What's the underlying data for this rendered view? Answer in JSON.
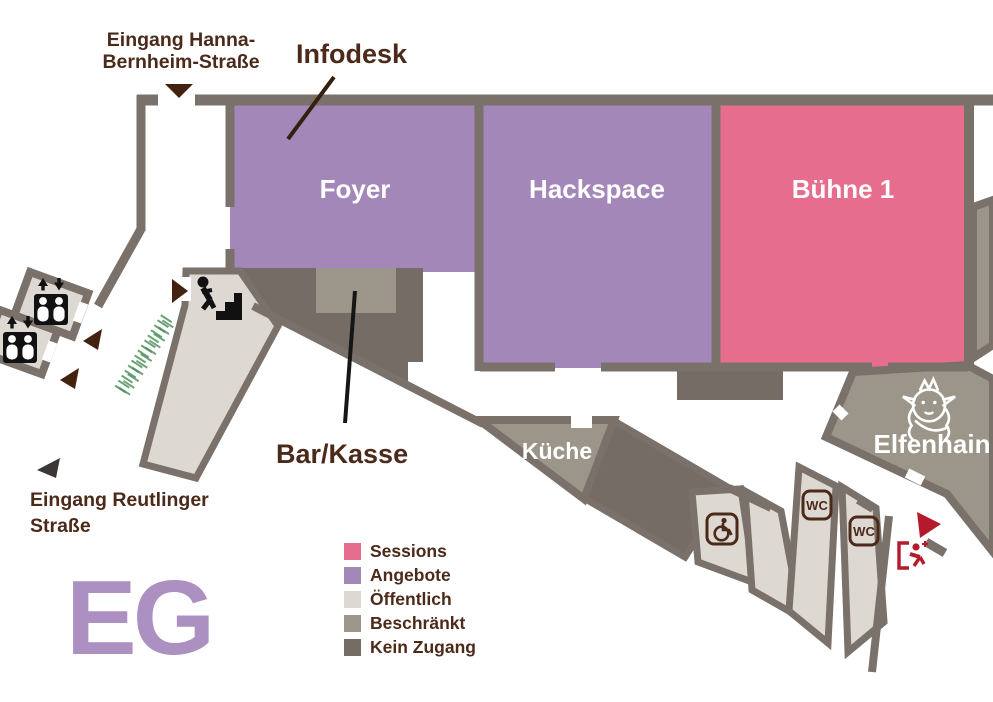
{
  "floor": {
    "label": "EG"
  },
  "colors": {
    "sessions": "#e66d8e",
    "angebote": "#a287b8",
    "oeffentlich": "#ded8d3",
    "beschraenkt": "#9b9689",
    "kein_zugang": "#756c66",
    "wall": "#7a716b",
    "label_brown": "#4b2a1a",
    "arrow_brown": "#42210f",
    "arrow_dark": "#3a3734",
    "exit_red": "#b51a2c",
    "hedge_green": "#6aa373",
    "eg_purple": "#ab90c1",
    "room_label_white": "#ffffff"
  },
  "rooms": {
    "foyer": {
      "label": "Foyer",
      "category": "Angebote"
    },
    "hackspace": {
      "label": "Hackspace",
      "category": "Angebote"
    },
    "buehne1": {
      "label": "Bühne 1",
      "category": "Sessions"
    },
    "kueche": {
      "label": "Küche",
      "category": "Beschränkt"
    },
    "elfenhain": {
      "label": "Elfenhain",
      "category": "Beschränkt"
    }
  },
  "annotations": {
    "infodesk": {
      "label": "Infodesk"
    },
    "bar_kasse": {
      "label": "Bar/Kasse"
    }
  },
  "entrances": {
    "hanna_bernheim": {
      "line1": "Eingang Hanna-",
      "line2": "Bernheim-Straße"
    },
    "reutlinger": {
      "line1": "Eingang Reutlinger",
      "line2": "Straße"
    }
  },
  "legend": {
    "items": [
      {
        "label": "Sessions",
        "color": "#e66d8e"
      },
      {
        "label": "Angebote",
        "color": "#a287b8"
      },
      {
        "label": "Öffentlich",
        "color": "#ded8d3"
      },
      {
        "label": "Beschränkt",
        "color": "#9b9689"
      },
      {
        "label": "Kein Zugang",
        "color": "#756c66"
      }
    ]
  },
  "icons": {
    "wc_label": "WC"
  }
}
